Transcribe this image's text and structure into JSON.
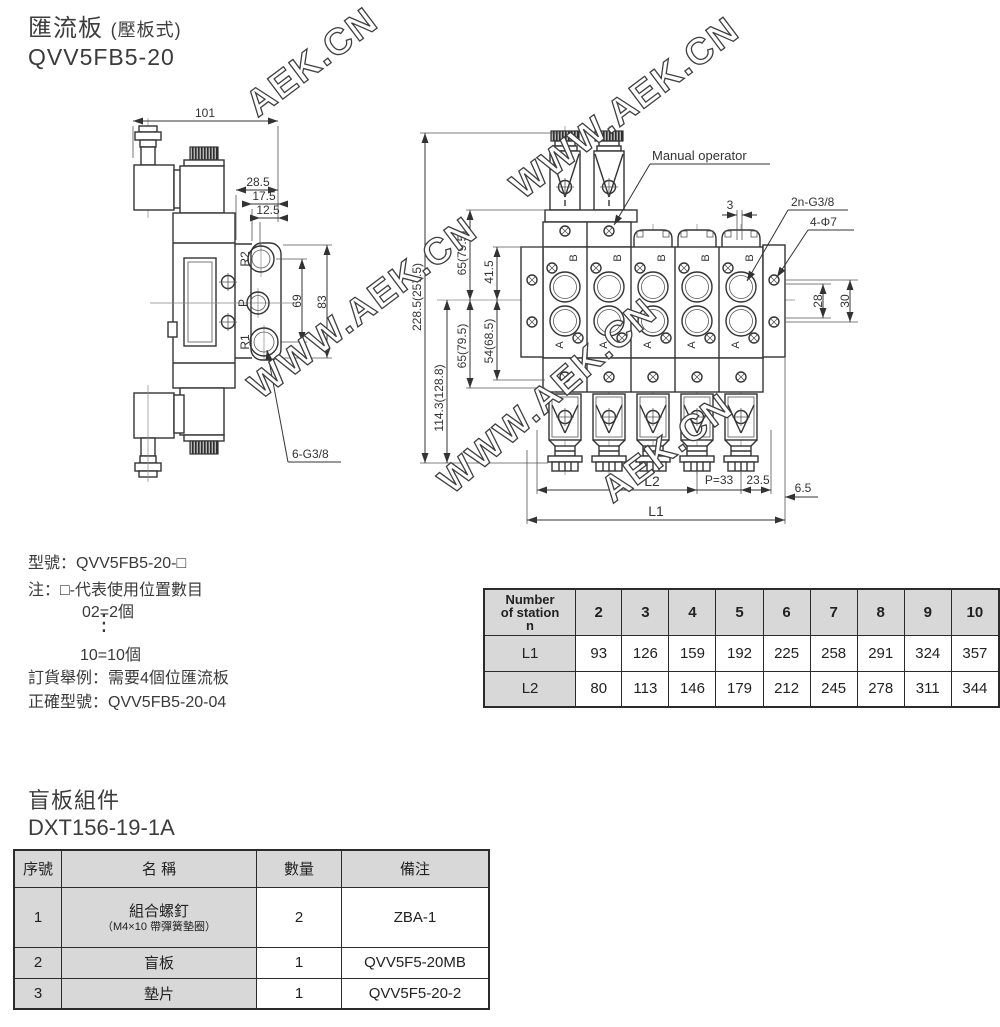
{
  "header": {
    "title": "匯流板",
    "title_suffix": "(壓板式)",
    "model": "QVV5FB5-20"
  },
  "watermark": {
    "full": "WWW.AEK.CN",
    "short": "AEK.CN"
  },
  "left_drawing": {
    "dim_101": "101",
    "dim_28_5": "28.5",
    "dim_17_5": "17.5",
    "dim_12_5": "12.5",
    "dim_69": "69",
    "dim_83": "83",
    "label_6_g38": "6-G3/8",
    "port_r2": "R2",
    "port_p": "P",
    "port_r1": "R1"
  },
  "right_drawing": {
    "label_manual": "Manual operator",
    "dim_3": "3",
    "label_2n_g38": "2n-G3/8",
    "label_4_phi7": "4-Φ7",
    "dim_total": "228.5(257.5)",
    "dim_65_top": "65(79.5)",
    "dim_41_5": "41.5",
    "dim_65_bottom": "65(79.5)",
    "dim_54": "54(68.5)",
    "dim_114": "114.3(128.8)",
    "dim_28": "28",
    "dim_30": "30",
    "dim_p33": "P=33",
    "dim_23_5": "23.5",
    "dim_6_5": "6.5",
    "dim_l1": "L1",
    "dim_l2": "L2",
    "port_b": "B",
    "port_a": "A"
  },
  "ordering": {
    "line_model": "型號：QVV5FB5-20-□",
    "line_note": "注：□-代表使用位置數目",
    "line_ex2": "02=2個",
    "dots": "⋮",
    "line_ex10": "10=10個",
    "line_order": "訂貨舉例：需要4個位匯流板",
    "line_correct": "正確型號：QVV5FB5-20-04"
  },
  "station_table": {
    "header_line1": "Number",
    "header_line2": "of station",
    "header_line3": "n",
    "stations": [
      "2",
      "3",
      "4",
      "5",
      "6",
      "7",
      "8",
      "9",
      "10"
    ],
    "l1_label": "L1",
    "l1": [
      "93",
      "126",
      "159",
      "192",
      "225",
      "258",
      "291",
      "324",
      "357"
    ],
    "l2_label": "L2",
    "l2": [
      "80",
      "113",
      "146",
      "179",
      "212",
      "245",
      "278",
      "311",
      "344"
    ]
  },
  "blank_plate": {
    "title": "盲板組件",
    "model": "DXT156-19-1A",
    "headers": [
      "序號",
      "名  稱",
      "數量",
      "備注"
    ],
    "rows": [
      {
        "no": "1",
        "name": "組合螺釘",
        "name_sub": "（M4×10 帶彈簧墊圈）",
        "qty": "2",
        "remark": "ZBA-1"
      },
      {
        "no": "2",
        "name": "盲板",
        "name_sub": "",
        "qty": "1",
        "remark": "QVV5F5-20MB"
      },
      {
        "no": "3",
        "name": "墊片",
        "name_sub": "",
        "qty": "1",
        "remark": "QVV5F5-20-2"
      }
    ]
  },
  "colors": {
    "line": "#333333",
    "table_header_bg": "#d8d8d8",
    "text": "#333333"
  }
}
